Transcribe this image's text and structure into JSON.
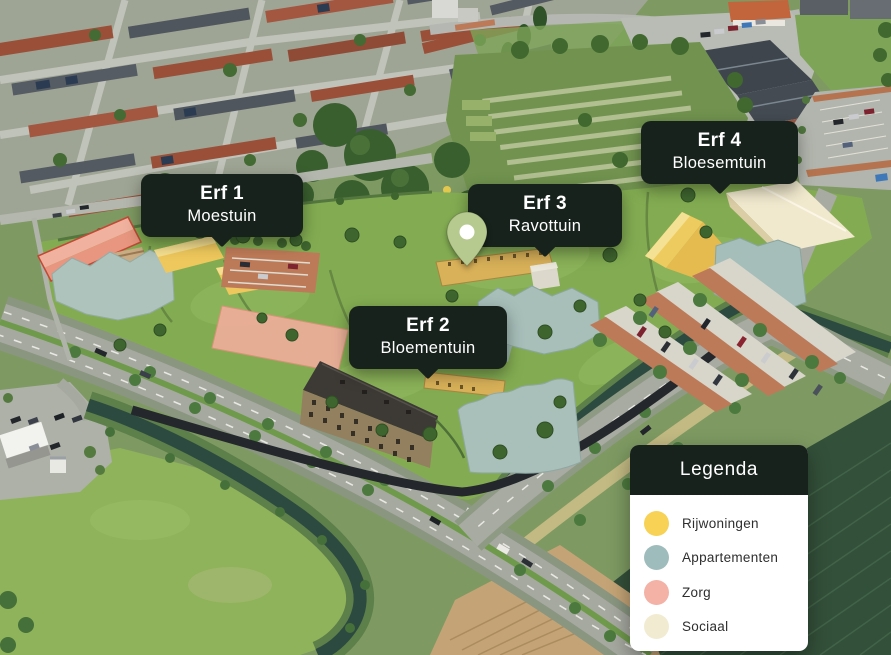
{
  "map": {
    "markers": [
      {
        "title": "Erf 1",
        "subtitle": "Moestuin"
      },
      {
        "title": "Erf 2",
        "subtitle": "Bloementuin"
      },
      {
        "title": "Erf 3",
        "subtitle": "Ravottuin"
      },
      {
        "title": "Erf 4",
        "subtitle": "Bloesemtuin"
      }
    ],
    "pin": {
      "color": "#b6ca8f"
    }
  },
  "legend": {
    "title": "Legenda",
    "items": [
      {
        "label": "Rijwoningen",
        "color": "#f7d254"
      },
      {
        "label": "Appartementen",
        "color": "#9fbcbc"
      },
      {
        "label": "Zorg",
        "color": "#f4b1a5"
      },
      {
        "label": "Sociaal",
        "color": "#f1ebd1"
      }
    ]
  },
  "theme": {
    "panel_bg": "#17221c",
    "panel_text": "#ffffff"
  }
}
